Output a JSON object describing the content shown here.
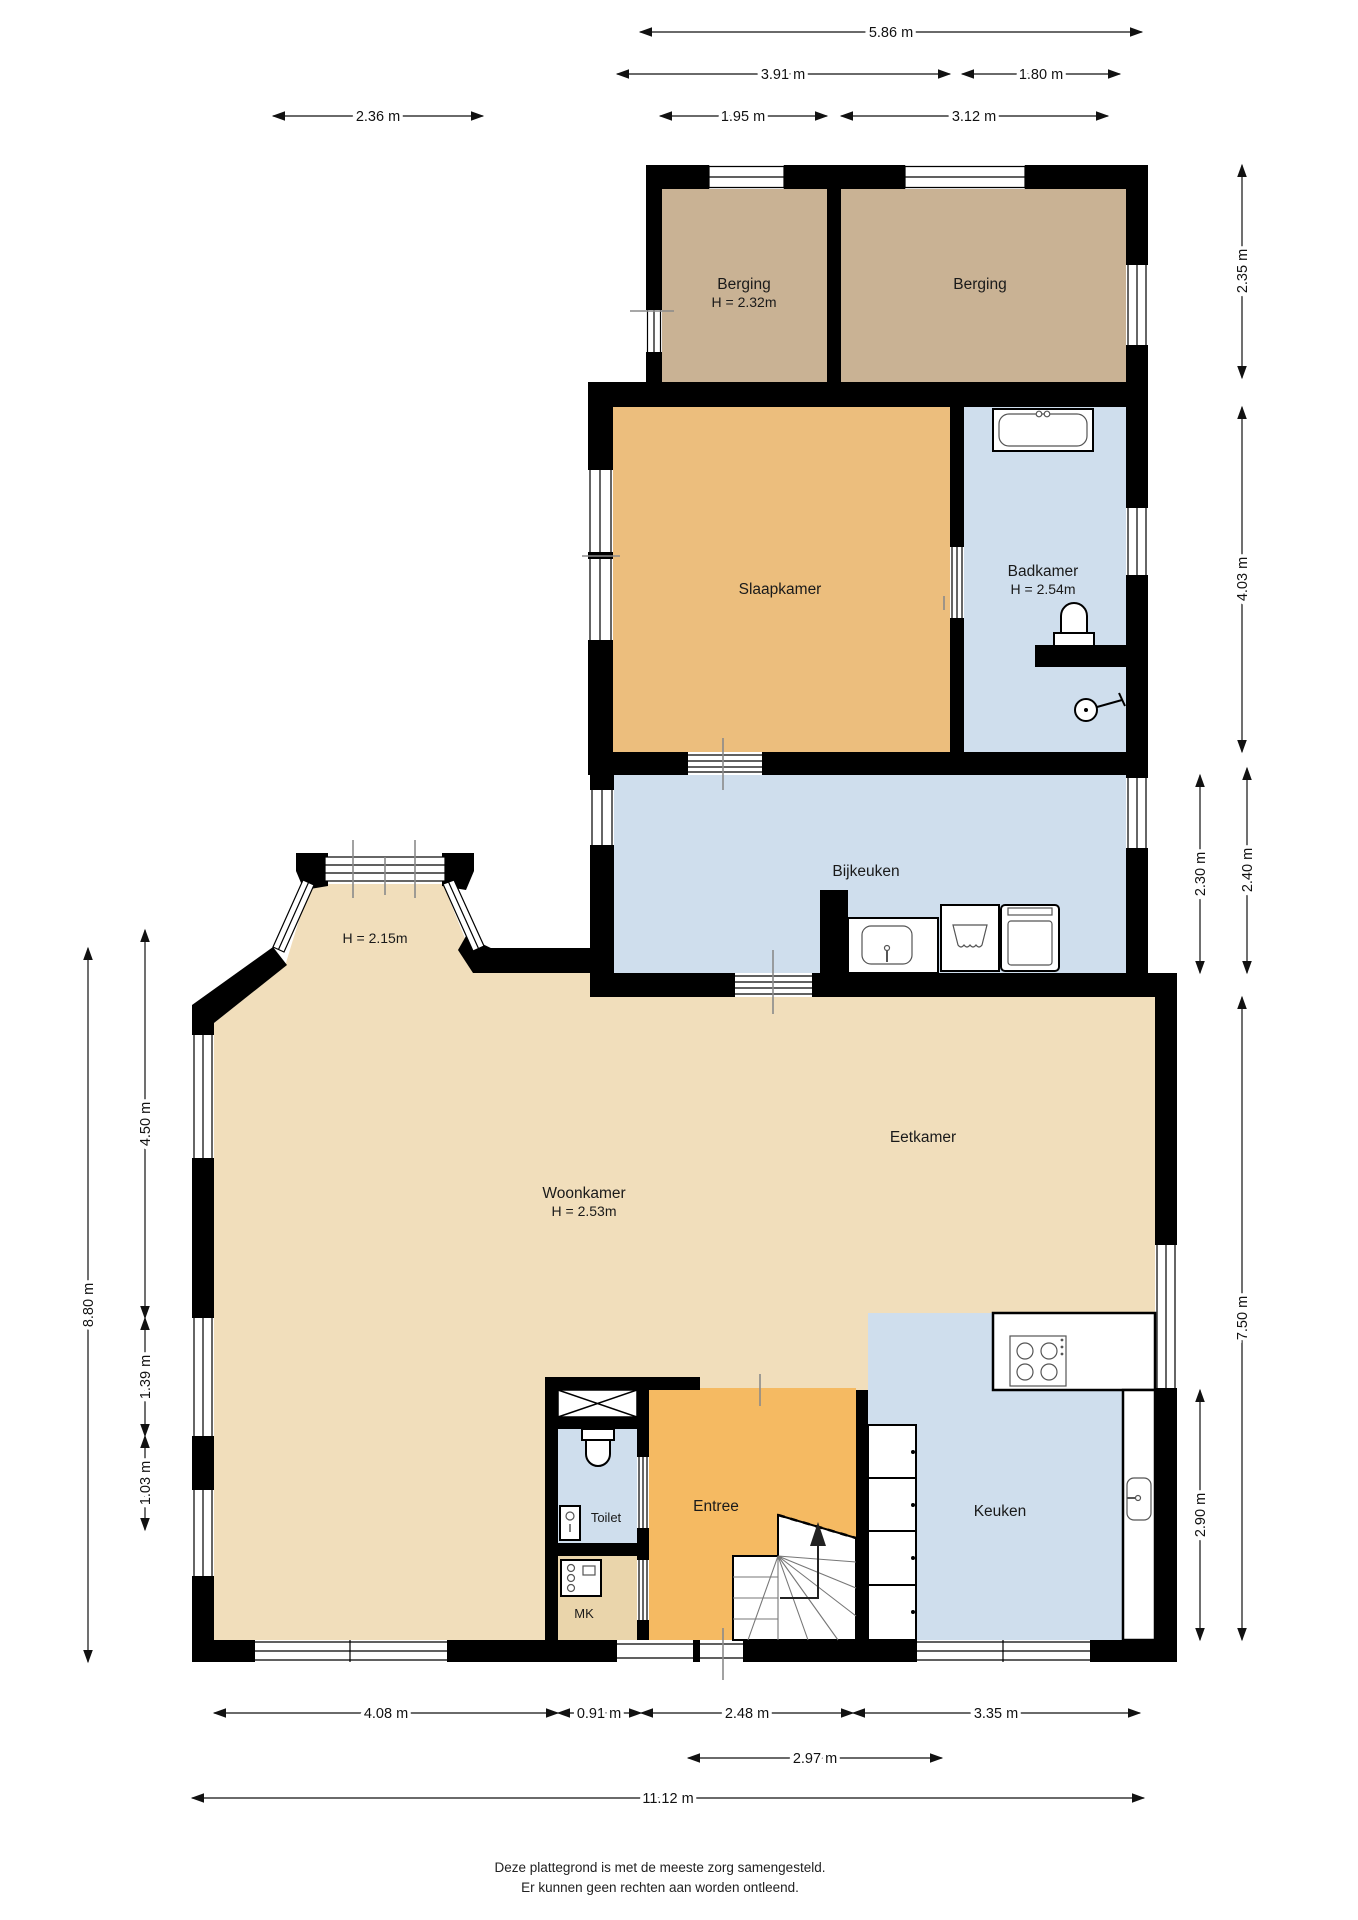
{
  "plan": {
    "rooms": {
      "berging_left": {
        "name": "Berging",
        "height": "H = 2.32m"
      },
      "berging_right": {
        "name": "Berging"
      },
      "slaapkamer": {
        "name": "Slaapkamer"
      },
      "badkamer": {
        "name": "Badkamer",
        "height": "H = 2.54m"
      },
      "bijkeuken": {
        "name": "Bijkeuken"
      },
      "erker": {
        "height": "H = 2.15m"
      },
      "woonkamer": {
        "name": "Woonkamer",
        "height": "H = 2.53m"
      },
      "eetkamer": {
        "name": "Eetkamer"
      },
      "toilet": {
        "name": "Toilet"
      },
      "mk": {
        "name": "MK"
      },
      "entree": {
        "name": "Entree"
      },
      "keuken": {
        "name": "Keuken"
      }
    },
    "dimensions": {
      "top": {
        "d1": "5.86 m",
        "d2": "3.91 m",
        "d3": "1.80 m",
        "d4": "1.95 m",
        "d5": "3.12 m",
        "d6": "2.36 m"
      },
      "right": {
        "d1": "2.35 m",
        "d2": "4.03 m",
        "d3": "2.30 m",
        "d4": "2.40 m",
        "d5": "7.50 m",
        "d6": "2.90 m"
      },
      "left": {
        "d1": "8.80 m",
        "d2": "4.50 m",
        "d3": "1.39 m",
        "d4": "1.03 m"
      },
      "bottom": {
        "d1": "4.08 m",
        "d2": "0.91 m",
        "d3": "2.48 m",
        "d4": "3.35 m",
        "d5": "2.97 m",
        "d6": "11.12 m"
      }
    },
    "disclaimer": {
      "line1": "Deze plattegrond is met de meeste zorg samengesteld.",
      "line2": "Er kunnen geen rechten aan worden ontleend."
    },
    "colors": {
      "wall": "#000000",
      "storage": "#c9b294",
      "bedroom": "#ecbe7d",
      "wet": "#cfdeed",
      "living": "#f1debb",
      "hall": "#f5ba62",
      "mk_floor": "#ead5ab"
    }
  }
}
